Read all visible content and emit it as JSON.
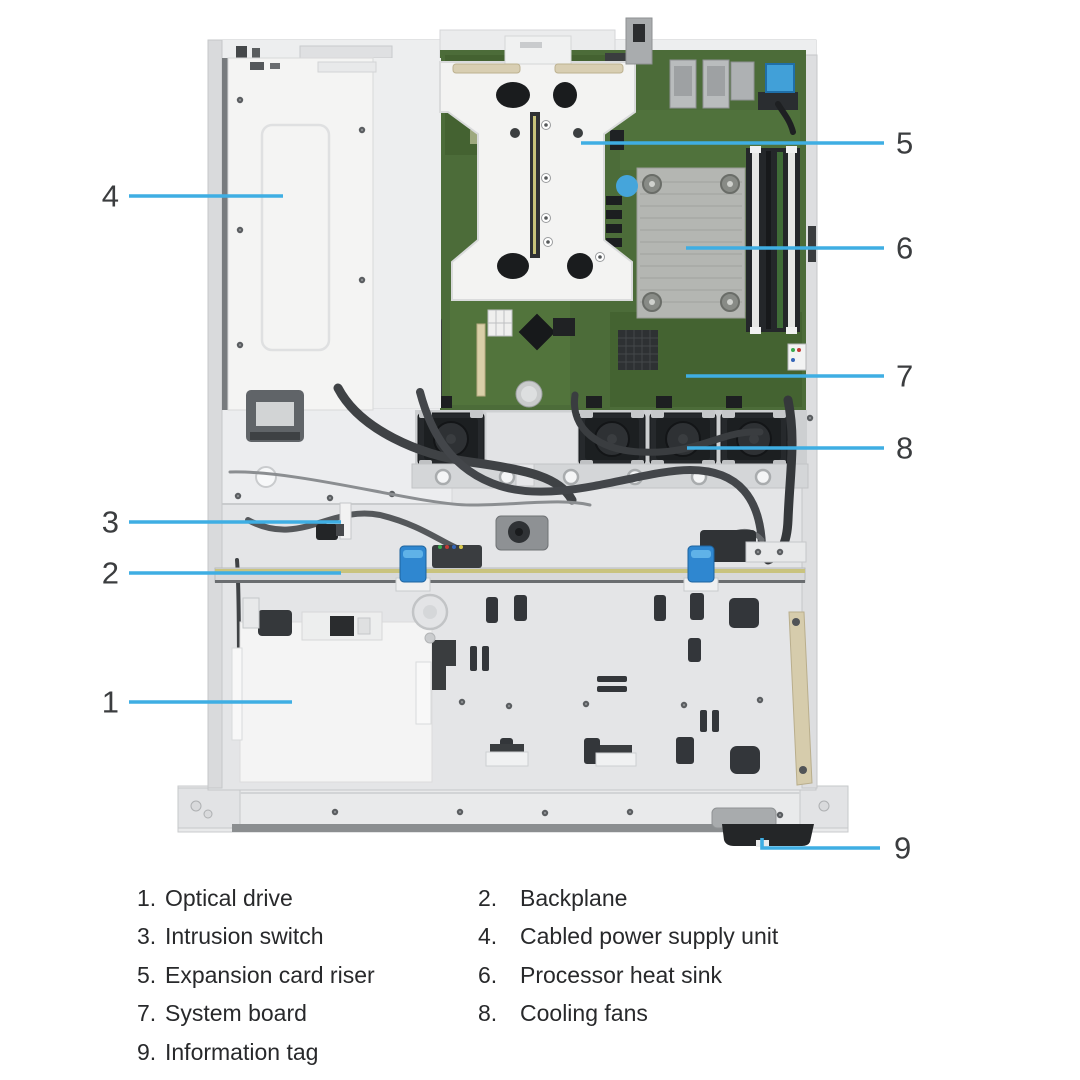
{
  "diagram": {
    "description": "Top view of server chassis interior with numbered component callouts",
    "callouts": [
      {
        "num": "1"
      },
      {
        "num": "2"
      },
      {
        "num": "3"
      },
      {
        "num": "4"
      },
      {
        "num": "5"
      },
      {
        "num": "6"
      },
      {
        "num": "7"
      },
      {
        "num": "8"
      },
      {
        "num": "9"
      }
    ]
  },
  "legend": {
    "items": [
      {
        "num": "1.",
        "label": "Optical drive"
      },
      {
        "num": "2.",
        "label": "Backplane"
      },
      {
        "num": "3.",
        "label": "Intrusion switch"
      },
      {
        "num": "4.",
        "label": "Cabled power supply unit"
      },
      {
        "num": "5.",
        "label": "Expansion card riser"
      },
      {
        "num": "6.",
        "label": "Processor heat sink"
      },
      {
        "num": "7.",
        "label": "System board"
      },
      {
        "num": "8.",
        "label": "Cooling fans"
      },
      {
        "num": "9.",
        "label": "Information tag"
      }
    ]
  },
  "colors": {
    "leader_line": "#3FAEE3",
    "callout_text": "#3B3D3F",
    "legend_text": "#28292B",
    "chassis_gray": "#E4E5E7",
    "board_green": "#4C6C39",
    "accent_blue": "#41A0D8",
    "backplane_yellow": "#C9C37E",
    "heatsink_gray": "#B4B6B2"
  }
}
